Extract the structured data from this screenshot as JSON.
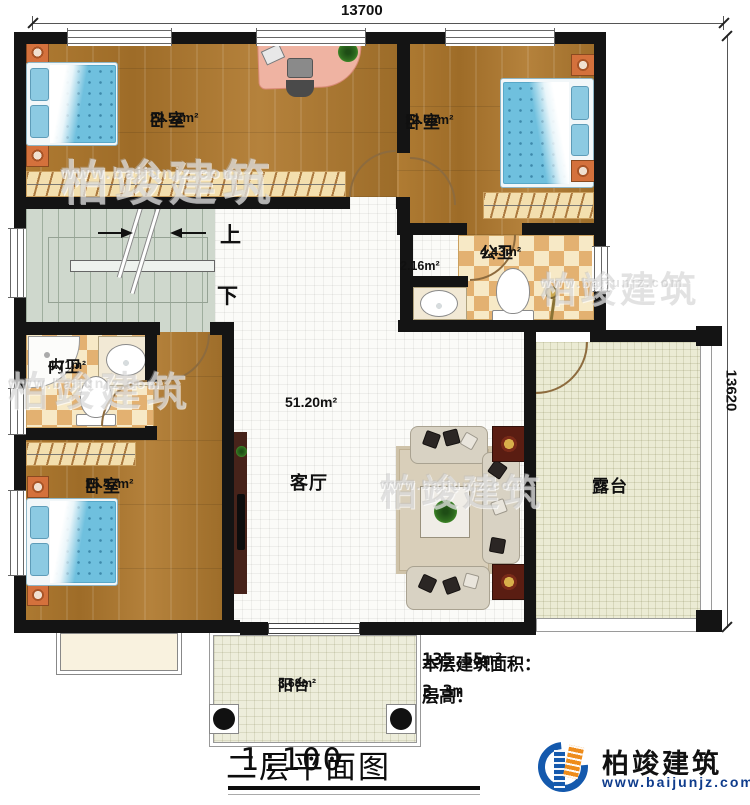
{
  "dimensions": {
    "top": "13700",
    "right": "13620"
  },
  "rooms": {
    "bedroom1": {
      "name": "卧室",
      "area": "22.52m²"
    },
    "bedroom2": {
      "name": "卧室",
      "area": "12.66m²"
    },
    "public_bath": {
      "name": "公卫",
      "area": "4.43m²"
    },
    "wash_area": {
      "area": "2.16m²"
    },
    "master_bath": {
      "name": "内卫",
      "area": "4.71m²"
    },
    "bedroom3": {
      "name": "卧室",
      "area": "15.47m²"
    },
    "living": {
      "name": "客厅",
      "area": "51.20m²"
    },
    "terrace": {
      "name": "露台"
    },
    "balcony": {
      "name": "阳台",
      "area": "3.68m²"
    }
  },
  "stairs": {
    "up": "上",
    "down": "下"
  },
  "info": {
    "area_label": "本层建筑面积：",
    "area_value": "135.55m²",
    "height_label": "层高：",
    "height_value": "3.3m"
  },
  "title": {
    "text": "二层平面图",
    "scale": "1:100"
  },
  "branding": {
    "company": "柏竣建筑",
    "website": "www.baijunjz.com"
  },
  "watermark": {
    "text": "柏竣建筑",
    "url": "www.baijunjz.com"
  },
  "colors": {
    "wall": "#141414",
    "wood": "#a9772f",
    "tile": "#fbfbf8",
    "stairs": "#cfd8cd",
    "terrace": "#ebebd4",
    "checker": "#e3b171",
    "bed": "#6fc0de",
    "end_table": "#5a1d12",
    "logo_blue": "#1459ad",
    "logo_orange": "#ee8c1b",
    "url_navy": "#0f3c8c"
  }
}
